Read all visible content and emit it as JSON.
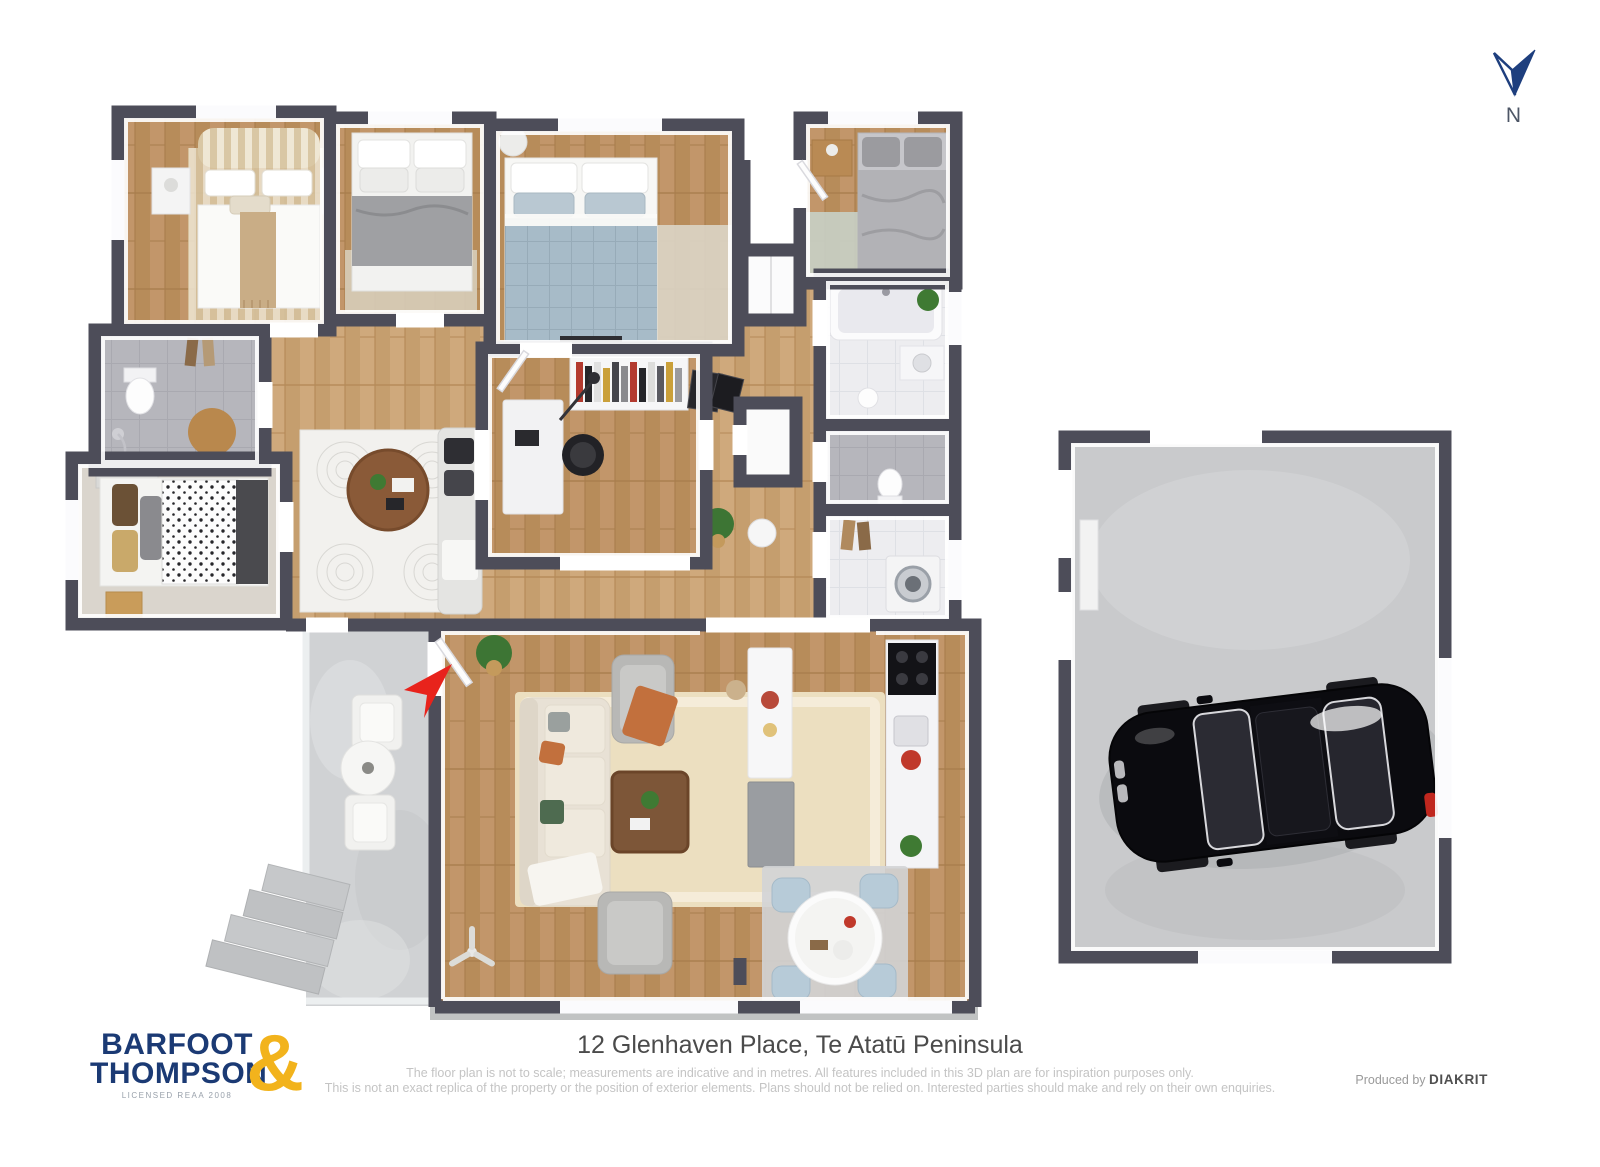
{
  "compass": {
    "label": "N",
    "arrow_color": "#1e3f7e"
  },
  "entrance_marker": {
    "color": "#e8231c"
  },
  "palette": {
    "wall": "#4d4d59",
    "wall_inner": "#ffffff",
    "floor_wood": "#b78c5a",
    "floor_wood_light": "#c59e6e",
    "floor_carpet": "#dad5cd",
    "floor_tile_white": "#ededf0",
    "floor_tile_grey": "#b6b6bc",
    "floor_concrete": "#d0d2d4",
    "garage_floor": "#c9cacc",
    "rug_cream": "#ecdfc0",
    "bed_blue": "#a7bbc8",
    "sofa_cream": "#e8e1d5",
    "dining_chair_blue": "#b7cbd8",
    "car_black": "#0b0b0f",
    "accent_red": "#e8231c",
    "brand_navy": "#1b3a74",
    "brand_gold": "#f2b31c"
  },
  "footer": {
    "logo": {
      "line1": "BARFOOT",
      "line2": "THOMPSON",
      "ampersand": "&",
      "sub": "LICENSED REAA 2008"
    },
    "address": "12 Glenhaven Place, Te Atatū Peninsula",
    "disclaimer_line1": "The floor plan is not to scale; measurements are indicative and in metres. All features included in this 3D plan are for inspiration purposes only.",
    "disclaimer_line2": "This is not an exact replica of the property or the position of exterior elements. Plans should not be relied on. Interested parties should make and rely on their own enquiries.",
    "produced_by": "Produced by",
    "producer": "DIAKRIT"
  }
}
